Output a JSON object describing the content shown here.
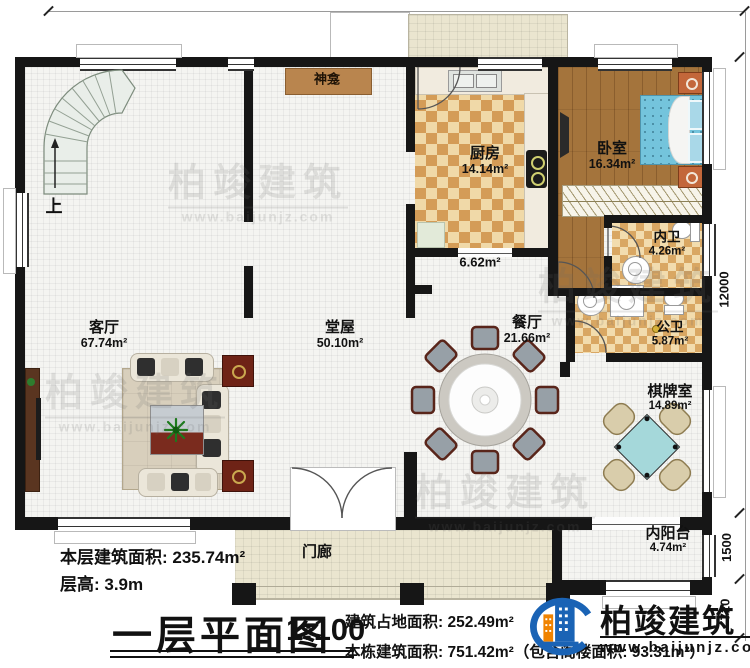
{
  "watermark": {
    "brand": "柏竣建筑",
    "site": "www.baijunjz.com"
  },
  "dimensions": {
    "top": "18500",
    "right_main": "12000",
    "right_balcony": "1500",
    "right_steps": "720"
  },
  "stair": {
    "up_label": "上"
  },
  "rooms": {
    "living": {
      "name": "客厅",
      "area": "67.74m²"
    },
    "hall": {
      "name": "堂屋",
      "area": "50.10m²"
    },
    "kitchen": {
      "name": "厨房",
      "area": "14.14m²"
    },
    "bedroom": {
      "name": "卧室",
      "area": "16.34m²"
    },
    "inner_bath": {
      "name": "内卫",
      "area": "4.26m²"
    },
    "public_bath": {
      "name": "公卫",
      "area": "5.87m²"
    },
    "dining": {
      "name": "餐厅",
      "area": "21.66m²"
    },
    "chess_room": {
      "name": "棋牌室",
      "area": "14.89m²"
    },
    "inner_balcony": {
      "name": "内阳台",
      "area": "4.74m²"
    },
    "porch": {
      "name": "门廊"
    },
    "shrine": {
      "name": "神龛"
    },
    "corridor": {
      "area": "6.62m²"
    }
  },
  "footer": {
    "floor_area": "本层建筑面积: 235.74m²",
    "floor_height": "层高: 3.9m",
    "title": "一层平面图",
    "scale": "1:100",
    "site_area": "建筑占地面积: 252.49m²",
    "total_area": "本栋建筑面积: 751.42m²（包含阁楼面积: 93.31m²）",
    "brand": "柏竣建筑",
    "site": "www.baijunjz.com"
  }
}
